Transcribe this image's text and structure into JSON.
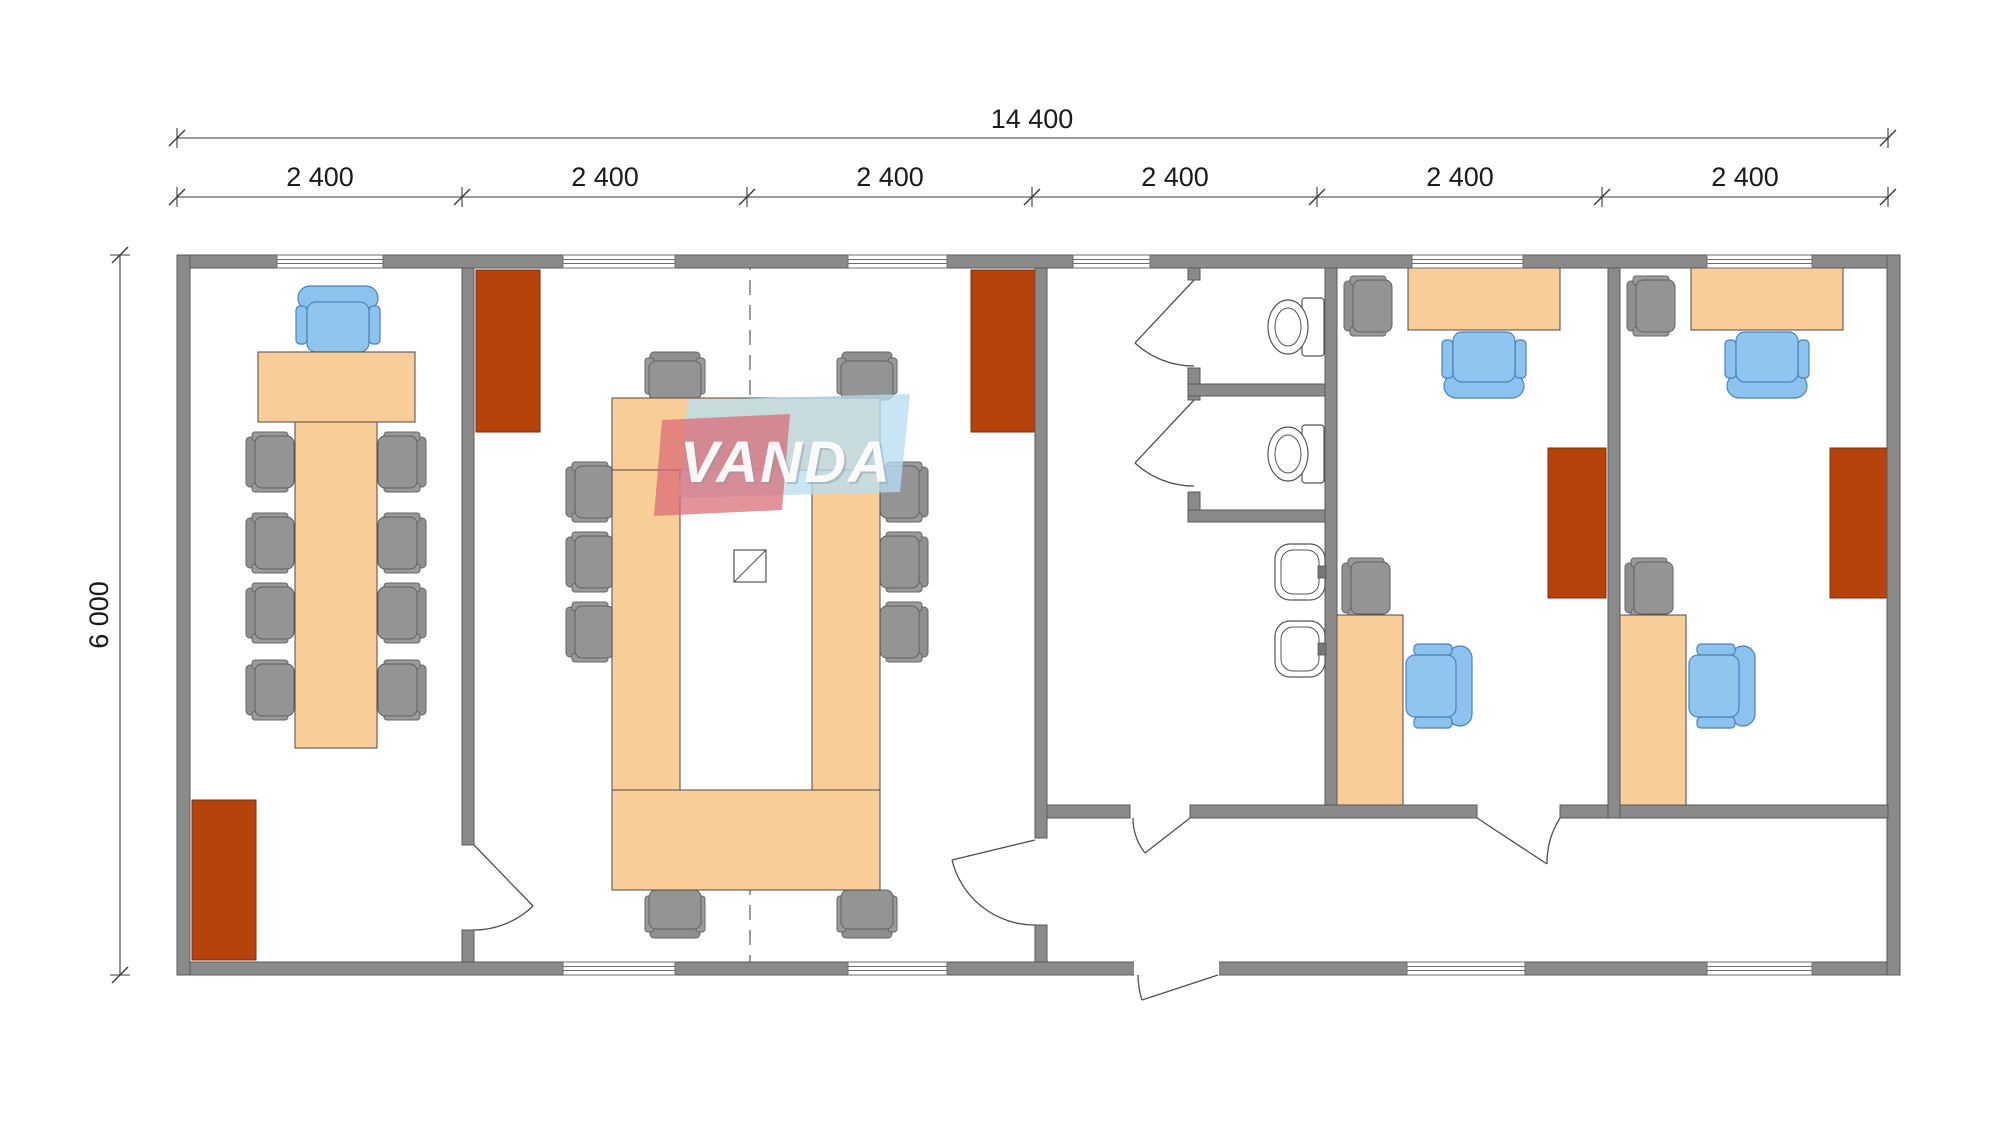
{
  "dimensions": {
    "total_width": "14 400",
    "modules": [
      "2 400",
      "2 400",
      "2 400",
      "2 400",
      "2 400",
      "2 400"
    ],
    "total_depth": "6 000"
  },
  "watermark": {
    "brand": "VANDA"
  },
  "colors": {
    "wall_gray": "#8a8a8a",
    "furniture_wood": "#f9cd98",
    "cabinet_brown": "#b5430b",
    "chair_gray": "#949494",
    "chair_blue": "#8cc2ee",
    "watermark_blue": "#b9def2",
    "watermark_red": "#d96a74"
  },
  "floor_plan": {
    "building": {
      "modules": 6,
      "module_width_label": "2 400",
      "width_label": "14 400",
      "depth_label": "6 000"
    },
    "rooms": [
      {
        "id": "office-left",
        "contents": "head desk, executive chair, long 8-seat table, 8 gray chairs, radiator"
      },
      {
        "id": "meeting-room",
        "contents": "ring conference table, 10 gray chairs, 2 radiators, module split line, floor box"
      },
      {
        "id": "washroom",
        "contents": "2 WC cubicles with toilets, 2 wash basins, corridor"
      },
      {
        "id": "office-middle",
        "contents": "2 desks, 2 blue task chairs, 2 gray side chairs, radiator"
      },
      {
        "id": "office-right",
        "contents": "2 desks, 2 blue task chairs, 2 gray side chairs, radiator"
      },
      {
        "id": "entrance-lobby",
        "contents": "entrance door, corridor along south wall"
      }
    ]
  }
}
